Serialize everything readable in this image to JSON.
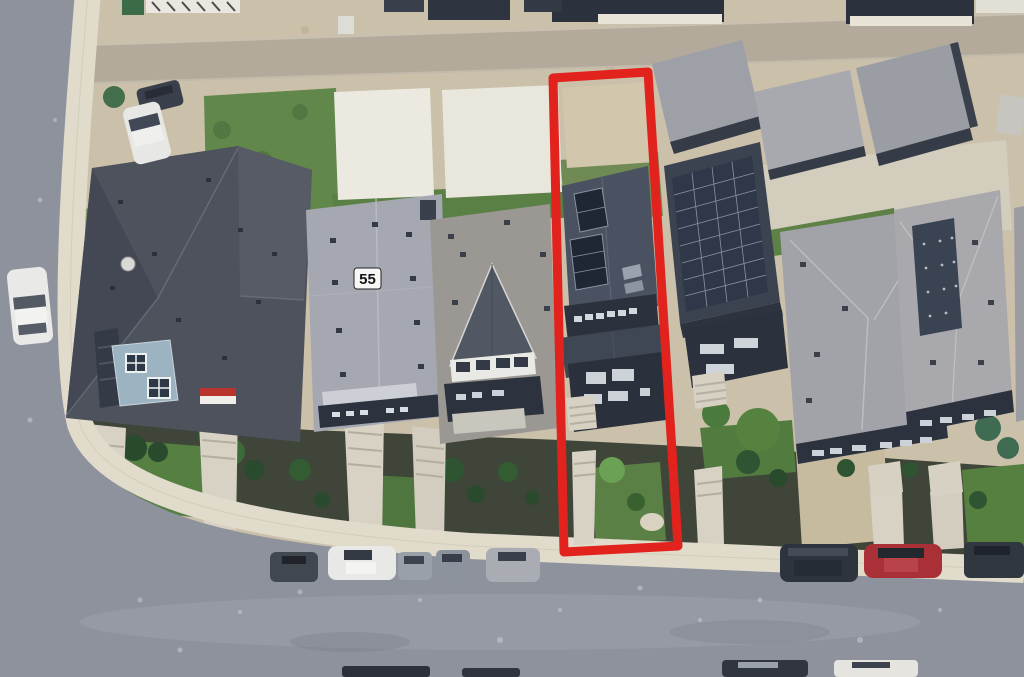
{
  "scene": {
    "type": "aerial-satellite-photo",
    "description": "Oblique aerial view of a residential block; a red rectangle outlines a narrow vacant-style infill lot with a tall skinny house, between a house numbered 55 area and a solar-panel house",
    "house_number_label": "55",
    "highlight": {
      "shape": "lot-boundary-rectangle",
      "color": "#e2231d",
      "stroke_width": 9
    },
    "palette": {
      "dirt": "#cbc1aa",
      "alley": "#b3aa9c",
      "asphalt": "#8e929d",
      "sidewalk": "#e0dbcb",
      "concrete_pad": "#eceae0",
      "lawn_grass": "#61884a",
      "front_grass": "#567f42",
      "mulch_bed": "#3f4539",
      "roof_dark_charcoal": "#4d525c",
      "roof_light_gray": "#a6a8b1",
      "roof_warm_gray": "#9b9894",
      "highlight_house_roof": "#4a5160",
      "solar_panel": "#2e3848",
      "facade_navy": "#2c323e",
      "walkway_concrete": "#d7d2c4",
      "car_white": "#e9e9e7",
      "car_red": "#a93036",
      "car_dark": "#31373f"
    }
  }
}
